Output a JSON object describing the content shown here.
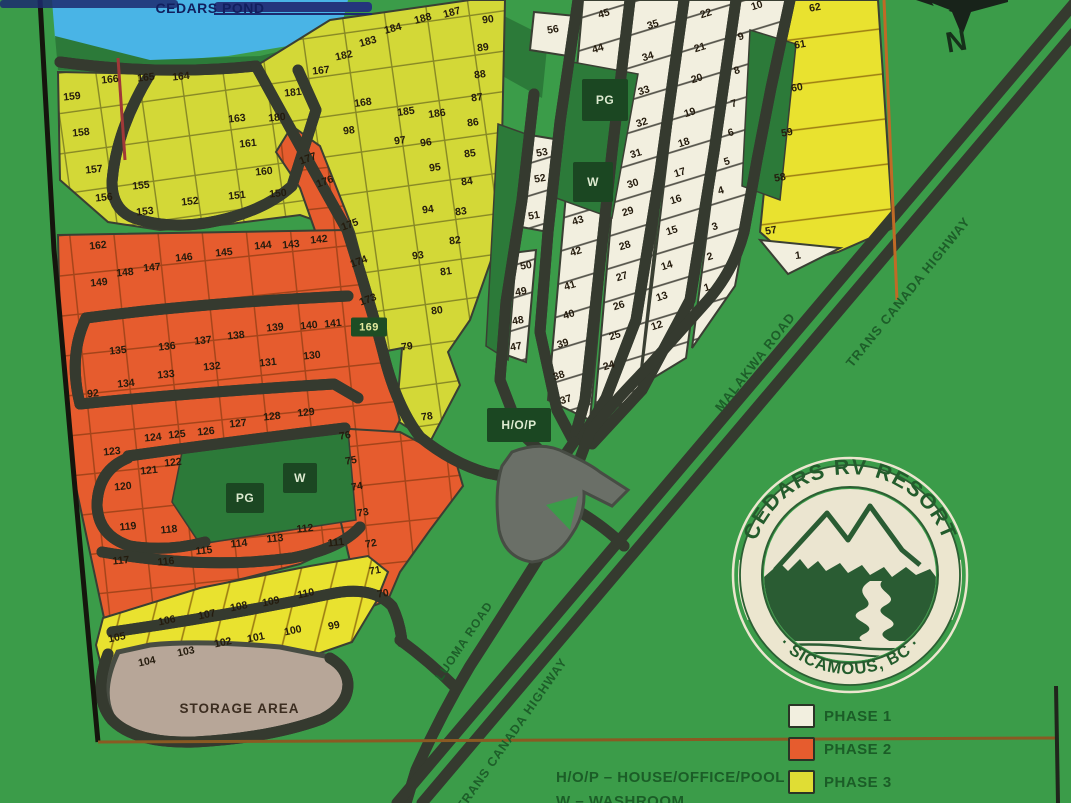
{
  "pond": {
    "label": "CEDARS POND"
  },
  "storage": {
    "label": "STORAGE AREA"
  },
  "compass": {
    "label": "N"
  },
  "roads": {
    "malakwa": "MALAKWA ROAD",
    "tch_upper": "TRANS CANADA HIGHWAY",
    "tch_lower": "TRANS CANADA HIGHWAY",
    "luoma": "LUOMA ROAD"
  },
  "logo": {
    "top": "CEDARS RV RESORT",
    "bottom": "· SICAMOUS, BC ·"
  },
  "legend": {
    "items": [
      {
        "label": "PHASE 1",
        "color": "#f2efdf"
      },
      {
        "label": "PHASE 2",
        "color": "#e65c2e"
      },
      {
        "label": "PHASE 3",
        "color": "#e0dd34"
      }
    ]
  },
  "key": {
    "line1": "H/O/P – HOUSE/OFFICE/POOL",
    "line2": "W – WASHROOM"
  },
  "colors": {
    "land": "#3b9c49",
    "dark_green": "#2c7a39",
    "pond_blue": "#49b4e6",
    "road": "#5d625a",
    "phase1": "#f2efdf",
    "phase2": "#e65c2e",
    "phase3": "#d3d837",
    "phase3_bright": "#e9e22f",
    "marker_bg": "#1b4722",
    "storage_gray": "#b7a698"
  },
  "markers": [
    {
      "label": "PG",
      "x": 605,
      "y": 100,
      "w": 46,
      "h": 42,
      "cls": ""
    },
    {
      "label": "W",
      "x": 593,
      "y": 182,
      "w": 40,
      "h": 40,
      "cls": ""
    },
    {
      "label": "H/O/P",
      "x": 519,
      "y": 425,
      "w": 64,
      "h": 34,
      "cls": ""
    },
    {
      "label": "PG",
      "x": 245,
      "y": 498,
      "w": 38,
      "h": 30,
      "cls": ""
    },
    {
      "label": "W",
      "x": 300,
      "y": 478,
      "w": 34,
      "h": 30,
      "cls": ""
    },
    {
      "label": "169",
      "x": 369,
      "y": 327,
      "w": 36,
      "h": 19,
      "cls": "tag"
    }
  ],
  "lots": {
    "phase1": [
      [
        56,
        553,
        30,
        -10
      ],
      [
        53,
        542,
        153,
        -10
      ],
      [
        52,
        540,
        179,
        -10
      ],
      [
        51,
        534,
        216,
        -10
      ],
      [
        50,
        526,
        266,
        -10
      ],
      [
        49,
        521,
        292,
        -10
      ],
      [
        48,
        518,
        321,
        -10
      ],
      [
        47,
        516,
        347,
        -10
      ],
      [
        45,
        604,
        14,
        -17
      ],
      [
        44,
        598,
        49,
        -17
      ],
      [
        43,
        578,
        221,
        -17
      ],
      [
        42,
        576,
        252,
        -17
      ],
      [
        41,
        570,
        286,
        -17
      ],
      [
        40,
        569,
        315,
        -17
      ],
      [
        39,
        563,
        344,
        -17
      ],
      [
        38,
        559,
        376,
        -17
      ],
      [
        37,
        566,
        400,
        -17
      ],
      [
        35,
        653,
        25,
        -17
      ],
      [
        34,
        648,
        57,
        -17
      ],
      [
        33,
        644,
        91,
        -17
      ],
      [
        32,
        642,
        123,
        -17
      ],
      [
        31,
        636,
        154,
        -17
      ],
      [
        30,
        633,
        184,
        -17
      ],
      [
        29,
        628,
        212,
        -17
      ],
      [
        28,
        625,
        246,
        -17
      ],
      [
        27,
        622,
        277,
        -17
      ],
      [
        26,
        619,
        306,
        -17
      ],
      [
        25,
        615,
        336,
        -17
      ],
      [
        24,
        609,
        366,
        -17
      ],
      [
        22,
        706,
        14,
        -17
      ],
      [
        21,
        700,
        48,
        -17
      ],
      [
        20,
        697,
        79,
        -17
      ],
      [
        19,
        690,
        113,
        -17
      ],
      [
        18,
        684,
        143,
        -17
      ],
      [
        17,
        680,
        173,
        -17
      ],
      [
        16,
        676,
        200,
        -17
      ],
      [
        15,
        672,
        231,
        -17
      ],
      [
        14,
        667,
        266,
        -17
      ],
      [
        13,
        662,
        297,
        -17
      ],
      [
        12,
        657,
        326,
        -17
      ],
      [
        10,
        757,
        6,
        -17
      ],
      [
        9,
        741,
        37,
        -17
      ],
      [
        8,
        737,
        71,
        -17
      ],
      [
        7,
        734,
        104,
        -17
      ],
      [
        6,
        731,
        133,
        -17
      ],
      [
        5,
        727,
        162,
        -17
      ],
      [
        4,
        721,
        191,
        -17
      ],
      [
        3,
        715,
        227,
        -17
      ],
      [
        2,
        710,
        257,
        -17
      ],
      [
        1,
        707,
        288,
        -17
      ],
      [
        1,
        798,
        256,
        -8
      ]
    ],
    "phase2": [
      [
        162,
        98,
        246,
        -6
      ],
      [
        149,
        99,
        283,
        -6
      ],
      [
        148,
        125,
        273,
        -6
      ],
      [
        147,
        152,
        268,
        -6
      ],
      [
        146,
        184,
        258,
        -6
      ],
      [
        145,
        224,
        253,
        -6
      ],
      [
        144,
        263,
        246,
        -6
      ],
      [
        143,
        291,
        245,
        -6
      ],
      [
        142,
        319,
        240,
        -6
      ],
      [
        177,
        308,
        159,
        -20
      ],
      [
        176,
        325,
        182,
        -20
      ],
      [
        175,
        350,
        225,
        -20
      ],
      [
        174,
        359,
        262,
        -20
      ],
      [
        173,
        368,
        300,
        -20
      ],
      [
        135,
        118,
        351,
        -6
      ],
      [
        136,
        167,
        347,
        -6
      ],
      [
        137,
        203,
        341,
        -6
      ],
      [
        138,
        236,
        336,
        -6
      ],
      [
        139,
        275,
        328,
        -6
      ],
      [
        140,
        309,
        326,
        -6
      ],
      [
        141,
        333,
        324,
        -6
      ],
      [
        134,
        126,
        384,
        -6
      ],
      [
        133,
        166,
        375,
        -6
      ],
      [
        132,
        212,
        367,
        -6
      ],
      [
        131,
        268,
        363,
        -6
      ],
      [
        130,
        312,
        356,
        -6
      ],
      [
        92,
        93,
        394,
        -6
      ],
      [
        123,
        112,
        452,
        -6
      ],
      [
        124,
        153,
        438,
        -6
      ],
      [
        125,
        177,
        435,
        -6
      ],
      [
        126,
        206,
        432,
        -6
      ],
      [
        127,
        238,
        424,
        -6
      ],
      [
        128,
        272,
        417,
        -6
      ],
      [
        129,
        306,
        413,
        -6
      ],
      [
        122,
        173,
        463,
        -6
      ],
      [
        121,
        149,
        471,
        -6
      ],
      [
        120,
        123,
        487,
        -6
      ],
      [
        119,
        128,
        527,
        -6
      ],
      [
        118,
        169,
        530,
        -6
      ],
      [
        117,
        121,
        561,
        -6
      ],
      [
        116,
        166,
        562,
        -6
      ],
      [
        115,
        204,
        551,
        -6
      ],
      [
        114,
        239,
        544,
        -6
      ],
      [
        113,
        275,
        539,
        -6
      ],
      [
        112,
        305,
        529,
        -6
      ],
      [
        111,
        336,
        543,
        -6
      ],
      [
        76,
        345,
        436,
        -10
      ],
      [
        75,
        351,
        461,
        -10
      ],
      [
        74,
        357,
        487,
        -10
      ],
      [
        73,
        363,
        513,
        -10
      ],
      [
        72,
        371,
        544,
        -10
      ],
      [
        71,
        375,
        571,
        -10
      ],
      [
        70,
        383,
        594,
        -10
      ]
    ],
    "phase3": [
      [
        159,
        72,
        97,
        -6
      ],
      [
        166,
        110,
        80,
        -6
      ],
      [
        165,
        146,
        78,
        -6
      ],
      [
        164,
        181,
        77,
        -6
      ],
      [
        158,
        81,
        133,
        -6
      ],
      [
        157,
        94,
        170,
        -6
      ],
      [
        156,
        104,
        198,
        -6
      ],
      [
        155,
        141,
        186,
        -6
      ],
      [
        153,
        145,
        212,
        -6
      ],
      [
        152,
        190,
        202,
        -6
      ],
      [
        151,
        237,
        196,
        -6
      ],
      [
        150,
        278,
        194,
        -6
      ],
      [
        163,
        237,
        119,
        -6
      ],
      [
        161,
        248,
        144,
        -6
      ],
      [
        160,
        264,
        172,
        -6
      ],
      [
        180,
        277,
        118,
        -6
      ],
      [
        181,
        293,
        93,
        -6
      ],
      [
        167,
        321,
        71,
        -6
      ],
      [
        182,
        344,
        56,
        -12
      ],
      [
        183,
        368,
        42,
        -15
      ],
      [
        184,
        393,
        29,
        -15
      ],
      [
        188,
        423,
        19,
        -15
      ],
      [
        187,
        452,
        13,
        -15
      ],
      [
        185,
        406,
        112,
        -8
      ],
      [
        186,
        437,
        114,
        -8
      ],
      [
        168,
        363,
        103,
        -8
      ],
      [
        98,
        349,
        131,
        -8
      ],
      [
        97,
        400,
        141,
        -8
      ],
      [
        96,
        426,
        143,
        -8
      ],
      [
        95,
        435,
        168,
        -8
      ],
      [
        94,
        428,
        210,
        -8
      ],
      [
        93,
        418,
        256,
        -8
      ],
      [
        90,
        488,
        20,
        -8
      ],
      [
        89,
        483,
        48,
        -8
      ],
      [
        88,
        480,
        75,
        -8
      ],
      [
        87,
        477,
        98,
        -8
      ],
      [
        86,
        473,
        123,
        -8
      ],
      [
        85,
        470,
        154,
        -8
      ],
      [
        84,
        467,
        182,
        -8
      ],
      [
        83,
        461,
        212,
        -8
      ],
      [
        82,
        455,
        241,
        -8
      ],
      [
        81,
        446,
        272,
        -8
      ],
      [
        80,
        437,
        311,
        -8
      ],
      [
        79,
        407,
        347,
        -8
      ],
      [
        78,
        427,
        417,
        -8
      ],
      [
        62,
        815,
        8,
        -10
      ],
      [
        61,
        800,
        45,
        -10
      ],
      [
        60,
        797,
        88,
        -10
      ],
      [
        59,
        787,
        133,
        -10
      ],
      [
        58,
        780,
        178,
        -10
      ],
      [
        57,
        771,
        231,
        -10
      ],
      [
        110,
        306,
        594,
        -12
      ],
      [
        109,
        271,
        602,
        -12
      ],
      [
        108,
        239,
        607,
        -12
      ],
      [
        107,
        207,
        615,
        -12
      ],
      [
        106,
        167,
        621,
        -12
      ],
      [
        105,
        117,
        638,
        -12
      ],
      [
        104,
        147,
        662,
        -12
      ],
      [
        103,
        186,
        652,
        -12
      ],
      [
        102,
        223,
        643,
        -12
      ],
      [
        101,
        256,
        638,
        -12
      ],
      [
        100,
        293,
        631,
        -12
      ],
      [
        99,
        334,
        626,
        -12
      ]
    ]
  }
}
